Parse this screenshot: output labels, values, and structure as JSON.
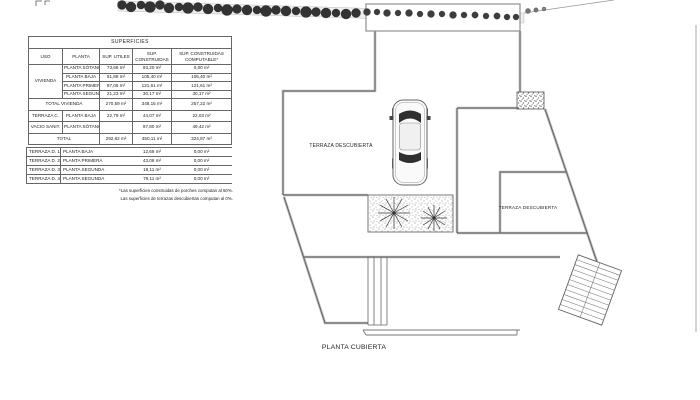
{
  "table": {
    "title": "SUPERFICIES",
    "headers": {
      "uso": "USO",
      "planta": "PLANTA",
      "utiles": "SUP. UTILES",
      "construidas": "SUP. CONSTRUIDAS",
      "computable": "SUP. CONSTRUIDAS COMPUTABLE*"
    },
    "vivienda_label": "VIVIENDA",
    "vivienda_rows": [
      {
        "planta": "PLANTA SÓTANO",
        "utiles": "73,68 m²",
        "construidas": "93,20 m²",
        "computable": "0,00 m²"
      },
      {
        "planta": "PLANTA BAJA",
        "utiles": "81,88 m²",
        "construidas": "105,40 m²",
        "computable": "105,40 m²"
      },
      {
        "planta": "PLANTA PRIMERA",
        "utiles": "97,06 m²",
        "construidas": "121,61 m²",
        "computable": "121,61 m²"
      },
      {
        "planta": "PLANTA SEGUNDA",
        "utiles": "21,23 m²",
        "construidas": "30,17 m²",
        "computable": "30,17 m²"
      }
    ],
    "total_vivienda": {
      "label": "TOTAL VIVIENDA",
      "utiles": "270,59 m²",
      "construidas": "348,15 m²",
      "computable": "257,22 m²"
    },
    "extra_rows": [
      {
        "uso": "TERRAZA C.",
        "planta": "PLANTA BAJA",
        "utiles": "22,79 m²",
        "construidas": "44,07 m²",
        "computable": "22,03 m²"
      },
      {
        "uso": "VACIO SANIT.",
        "planta": "PLANTA SÓTANO",
        "utiles": "",
        "construidas": "97,80 m²",
        "computable": "49,42 m²"
      }
    ],
    "total": {
      "label": "TOTAL",
      "utiles": "292,62 m²",
      "construidas": "450,11 m²",
      "computable": "324,87 m²"
    },
    "terrazas": [
      {
        "uso": "TERRAZA D. 1",
        "planta": "PLANTA BAJA",
        "construidas": "12,68 m²",
        "computable": "0,00 m²"
      },
      {
        "uso": "TERRAZA D. 2",
        "planta": "PLANTA PRIMERA",
        "construidas": "43,08 m²",
        "computable": "0,00 m²"
      },
      {
        "uso": "TERRAZA D. 3",
        "planta": "PLANTA SEGUNDA",
        "construidas": "18,11 m²",
        "computable": "0,00 m²"
      },
      {
        "uso": "TERRAZA D. 4",
        "planta": "PLANTA SEGUNDA",
        "construidas": "79,11 m²",
        "computable": "0,00 m²"
      }
    ],
    "footnotes": [
      "*Las superficies construidas de porches computan al 50%.",
      "Las superficies de terrazas descubiertas computan al 0%."
    ]
  },
  "plan": {
    "terrace_label_main": "TERRAZA DESCUBIERTA",
    "terrace_label_right": "TERRAZA DESCUBIERTA",
    "title": "PLANTA CUBIERTA"
  },
  "colors": {
    "wall_outer": "#b8b8b8",
    "wall_inner": "#5f5f5f",
    "tree": "#333333",
    "paper": "#ffffff"
  }
}
